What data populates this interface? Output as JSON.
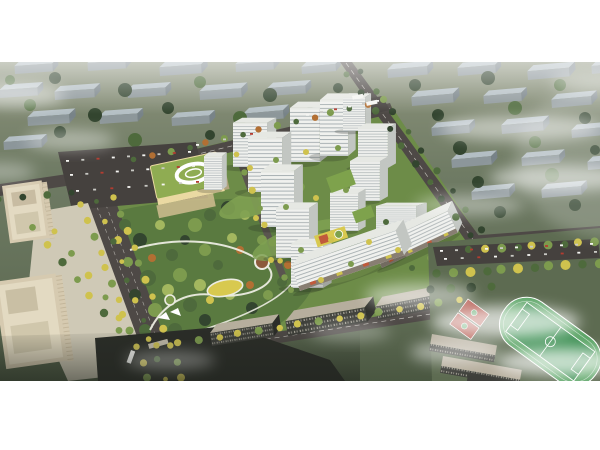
{
  "figure": {
    "kind": "aerial-architectural-rendering",
    "regions": [
      "context-housing-blocks",
      "perimeter-roads",
      "tree-lined-boulevard",
      "residential-towers",
      "central-park",
      "kindergarten",
      "office-buildings",
      "retail-mid-rise-slabs",
      "school-sports-field",
      "basketball-courts",
      "parking-lots",
      "clouds"
    ]
  },
  "palette": {
    "page_bg": "#ffffff",
    "ctx_ground_top": "#8b927b",
    "ctx_ground": "#6f7b64",
    "ctx_ground_low": "#55624a",
    "ctx_roof": "#b7c2c9",
    "ctx_side": "#8e989d",
    "ctx_side_dark": "#78838a",
    "tree_dark": "#33452f",
    "tree_mid": "#4e6a3c",
    "tree_bright": "#7d9b4e",
    "tree_lime": "#a3b75f",
    "tree_yellow": "#cfc24e",
    "tree_orange": "#b26f33",
    "road": "#4e4946",
    "road_line": "#d9d7d0",
    "asphalt_lot": "#45413e",
    "compound_green": "#6d8c48",
    "courtyard": "#7fa152",
    "park_base": "#5a7a40",
    "path": "#ecece2",
    "playground_yellow": "#d8c94f",
    "playground_red": "#c05a3c",
    "tower_front": "#f0f1ee",
    "tower_stripe": "#9aa3a7",
    "tower_side": "#c2c6c2",
    "tower_roof": "#e6e8e3",
    "podium_green": "#7ea24c",
    "retail_base": "#887e72",
    "kg_roof": "#8fac52",
    "kg_wall": "#ead9a2",
    "kg_shadow": "#b0a37f",
    "office_tan": "#d6cab0",
    "office_side": "#b5a98c",
    "office_roof": "#e3dac2",
    "plaza": "#cfc9b6",
    "dark_bld": "#3e3f3a",
    "dark_bld_roof": "#b6ae9d",
    "water": "#2b2d28",
    "field_green": "#3f9155",
    "track_green": "#5aa465",
    "court_red": "#ad4a3e",
    "school_ground": "#5d6b51",
    "cloud": "#ffffff",
    "vehicle_white": "#f5f5f2",
    "vehicle_silver": "#c9c9c4",
    "vehicle_red": "#b43c30"
  }
}
